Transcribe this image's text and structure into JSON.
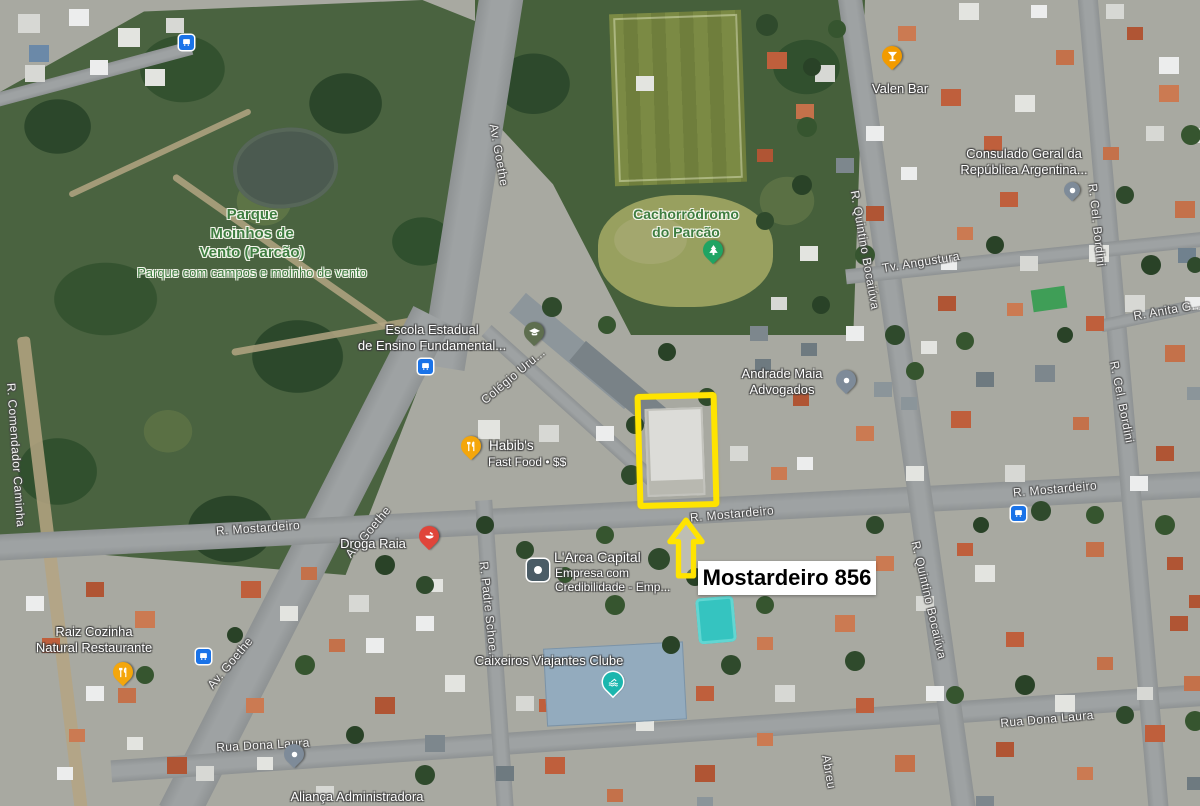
{
  "annotation": {
    "label": "Mostardeiro 856",
    "highlight_color": "#FFE400"
  },
  "pois": {
    "parque": {
      "name": "Parque\nMoinhos de\nVento (Parcão)",
      "subtitle": "Parque com campos e moinho de vento"
    },
    "cachorrodromo": {
      "name": "Cachorródromo\ndo Parcão",
      "icon": "tree-pin",
      "pin_color": "#1fa463"
    },
    "valen_bar": {
      "name": "Valen Bar",
      "icon": "cocktail-pin",
      "pin_color": "#f29b00"
    },
    "consulado": {
      "name": "Consulado Geral da\nRepública Argentina...",
      "icon": "place-pin",
      "pin_color": "#7e8b99"
    },
    "escola": {
      "name": "Escola Estadual\nde Ensino Fundamental...",
      "icon": "school-pin",
      "pin_color": "#5e6e4f"
    },
    "andrade": {
      "name": "Andrade Maia\nAdvogados",
      "icon": "place-pin",
      "pin_color": "#7e8b99"
    },
    "habibs": {
      "name": "Habib's",
      "subtitle": "Fast Food • $$",
      "icon": "restaurant-pin",
      "pin_color": "#f4a60b"
    },
    "droga_raia": {
      "name": "Droga Raia",
      "icon": "pharmacy-pin",
      "pin_color": "#e0453a"
    },
    "larca": {
      "name": "L'Arca Capital",
      "subtitle": "Empresa com\nCredibilidade - Emp...",
      "icon": "company-square",
      "icon_color": "#4a5c66"
    },
    "raiz": {
      "name": "Raiz Cozinha\nNatural Restaurante",
      "icon": "restaurant-pin",
      "pin_color": "#f4a60b"
    },
    "caixeiros": {
      "name": "Caixeiros Viajantes Clube",
      "icon": "pool-pin",
      "pin_color": "#1bb6ae"
    },
    "alianca": {
      "name": "Aliança Administradora",
      "icon": "place-pin",
      "pin_color": "#7e8b99"
    }
  },
  "streets": [
    {
      "name": "Av. Goethe"
    },
    {
      "name": "Av. Goethe"
    },
    {
      "name": "Av. Goethe"
    },
    {
      "name": "R. Mostardeiro"
    },
    {
      "name": "R. Mostardeiro"
    },
    {
      "name": "R. Mostardeiro"
    },
    {
      "name": "R. Quintino Bocaiúva"
    },
    {
      "name": "R. Quintino Bocaiúva"
    },
    {
      "name": "R. Cel. Bordini"
    },
    {
      "name": "R. Cel. Bordini"
    },
    {
      "name": "R. Anita G..."
    },
    {
      "name": "Tv. Angustura"
    },
    {
      "name": "Colégio Uru..."
    },
    {
      "name": "R. Padre Schoe..."
    },
    {
      "name": "R. Comendador Caminha"
    },
    {
      "name": "Rua Dona Laura"
    },
    {
      "name": "Rua Dona Laura"
    },
    {
      "name": "Abreu"
    }
  ]
}
